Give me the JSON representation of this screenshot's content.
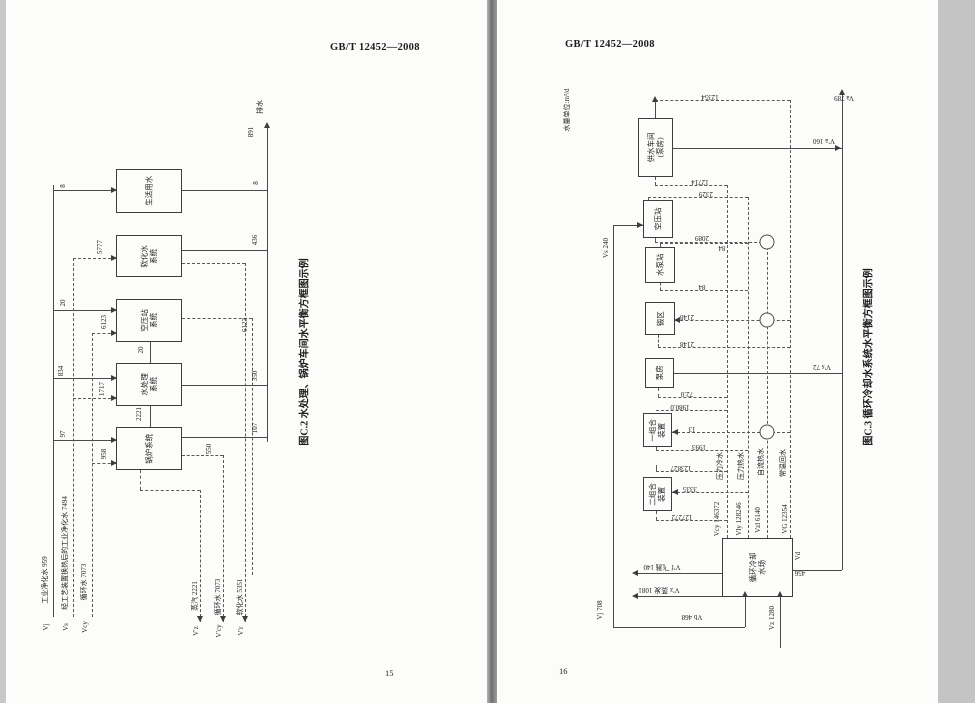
{
  "left_page": {
    "header": "GB/T 12452—2008",
    "page_number": "15",
    "caption": "图C.2  水处理、锅炉车间水平衡方框图示例",
    "boxes": [
      {
        "x": 116,
        "y": 169,
        "w": 66,
        "h": 44,
        "label": "生活用水"
      },
      {
        "x": 116,
        "y": 235,
        "w": 66,
        "h": 42,
        "label": "软化水\n系统"
      },
      {
        "x": 116,
        "y": 299,
        "w": 66,
        "h": 43,
        "label": "空压站\n系统"
      },
      {
        "x": 116,
        "y": 363,
        "w": 66,
        "h": 43,
        "label": "水处理\n系统"
      },
      {
        "x": 116,
        "y": 427,
        "w": 66,
        "h": 43,
        "label": "锅炉系统"
      }
    ],
    "labels": [
      {
        "x": 64,
        "y": 186,
        "t": "8",
        "r": -90
      },
      {
        "x": 64,
        "y": 303,
        "t": "20",
        "r": -90
      },
      {
        "x": 62,
        "y": 371,
        "t": "834",
        "r": -90
      },
      {
        "x": 64,
        "y": 434,
        "t": "97",
        "r": -90
      },
      {
        "x": 101,
        "y": 247,
        "t": "5777",
        "r": -90
      },
      {
        "x": 103,
        "y": 389,
        "t": "1717",
        "r": -90
      },
      {
        "x": 105,
        "y": 322,
        "t": "6123",
        "r": -90
      },
      {
        "x": 105,
        "y": 454,
        "t": "958",
        "r": -90
      },
      {
        "x": 142,
        "y": 350,
        "t": "20",
        "r": -90
      },
      {
        "x": 140,
        "y": 414,
        "t": "2221",
        "r": -90
      },
      {
        "x": 252,
        "y": 132,
        "t": "891",
        "r": -90
      },
      {
        "x": 261,
        "y": 107,
        "t": "排水",
        "r": -90
      },
      {
        "x": 257,
        "y": 183,
        "t": "8",
        "r": -90
      },
      {
        "x": 256,
        "y": 240,
        "t": "436",
        "r": -90
      },
      {
        "x": 256,
        "y": 376,
        "t": "350",
        "r": -90
      },
      {
        "x": 256,
        "y": 428,
        "t": "107",
        "r": -90
      },
      {
        "x": 246,
        "y": 325,
        "t": "6123",
        "r": -90
      },
      {
        "x": 210,
        "y": 449,
        "t": "550",
        "r": -90
      },
      {
        "x": 46,
        "y": 580,
        "t": "工业净化水 959",
        "r": -90
      },
      {
        "x": 66,
        "y": 553,
        "t": "经工艺装置换热后的工业净化水 7494",
        "r": -90
      },
      {
        "x": 85,
        "y": 582,
        "t": "循环水 7073",
        "r": -90
      },
      {
        "x": 196,
        "y": 596,
        "t": "蒸汽 2221",
        "r": -90
      },
      {
        "x": 219,
        "y": 597,
        "t": "循环水 7073",
        "r": -90
      },
      {
        "x": 241,
        "y": 597,
        "t": "软化水 5351",
        "r": -90
      },
      {
        "x": 47,
        "y": 627,
        "t": "Vj",
        "r": -90
      },
      {
        "x": 67,
        "y": 627,
        "t": "Vs",
        "r": -90
      },
      {
        "x": 86,
        "y": 627,
        "t": "Vcy",
        "r": -90
      },
      {
        "x": 197,
        "y": 631,
        "t": "V′z",
        "r": -90
      },
      {
        "x": 220,
        "y": 631,
        "t": "V′cy",
        "r": -90
      },
      {
        "x": 242,
        "y": 631,
        "t": "V′r",
        "r": -90
      }
    ],
    "solid": [
      [
        53,
        185,
        432,
        "v"
      ],
      [
        53,
        190,
        63,
        "h"
      ],
      [
        53,
        310,
        63,
        "h"
      ],
      [
        53,
        378,
        63,
        "h"
      ],
      [
        53,
        440,
        63,
        "h"
      ],
      [
        150,
        342,
        21,
        "v"
      ],
      [
        150,
        406,
        21,
        "v"
      ],
      [
        182,
        190,
        85,
        "h"
      ],
      [
        182,
        250,
        85,
        "h"
      ],
      [
        182,
        385,
        85,
        "h"
      ],
      [
        182,
        437,
        85,
        "h"
      ],
      [
        267,
        128,
        314,
        "v"
      ]
    ],
    "dashed": [
      [
        73,
        258,
        359,
        "v"
      ],
      [
        73,
        258,
        43,
        "h"
      ],
      [
        73,
        398,
        43,
        "h"
      ],
      [
        92,
        333,
        284,
        "v"
      ],
      [
        92,
        333,
        24,
        "h"
      ],
      [
        92,
        463,
        24,
        "h"
      ],
      [
        182,
        263,
        63,
        "h"
      ],
      [
        245,
        263,
        359,
        "v"
      ],
      [
        182,
        318,
        70,
        "h"
      ],
      [
        252,
        318,
        257,
        "v"
      ],
      [
        182,
        455,
        41,
        "h"
      ],
      [
        223,
        455,
        167,
        "v"
      ],
      [
        140,
        470,
        20,
        "v"
      ],
      [
        140,
        490,
        60,
        "h"
      ],
      [
        200,
        490,
        132,
        "v"
      ]
    ],
    "arrows": [
      [
        114,
        190,
        "r"
      ],
      [
        114,
        258,
        "r"
      ],
      [
        114,
        310,
        "r"
      ],
      [
        114,
        333,
        "r"
      ],
      [
        114,
        378,
        "r"
      ],
      [
        114,
        398,
        "r"
      ],
      [
        114,
        440,
        "r"
      ],
      [
        114,
        463,
        "r"
      ],
      [
        267,
        125,
        "u"
      ],
      [
        200,
        619,
        "d"
      ],
      [
        223,
        619,
        "d"
      ],
      [
        245,
        619,
        "d"
      ]
    ],
    "circles": []
  },
  "right_page": {
    "header": "GB/T 12452—2008",
    "page_number": "16",
    "caption": "图C.3  循环冷却水系统水平衡方框图示例",
    "unit_note": "水量单位:m³/d",
    "boxes": [
      {
        "x": 638,
        "y": 118,
        "w": 35,
        "h": 59,
        "label": "供水车间\n(泵房)"
      },
      {
        "x": 643,
        "y": 200,
        "w": 30,
        "h": 38,
        "label": "空压站"
      },
      {
        "x": 645,
        "y": 247,
        "w": 30,
        "h": 36,
        "label": "水泵站"
      },
      {
        "x": 645,
        "y": 302,
        "w": 30,
        "h": 33,
        "label": "锻区"
      },
      {
        "x": 645,
        "y": 358,
        "w": 29,
        "h": 30,
        "label": "泵房"
      },
      {
        "x": 643,
        "y": 413,
        "w": 29,
        "h": 34,
        "label": "一组合\n装置"
      },
      {
        "x": 643,
        "y": 477,
        "w": 29,
        "h": 34,
        "label": "二组合\n装置"
      },
      {
        "x": 722,
        "y": 538,
        "w": 71,
        "h": 59,
        "label": "循环冷却\n水场"
      }
    ],
    "labels": [
      {
        "x": 568,
        "y": 110,
        "t": "水量单位:m³/d",
        "r": -90
      },
      {
        "x": 607,
        "y": 248,
        "t": "Vs 240",
        "r": -90
      },
      {
        "x": 601,
        "y": 610,
        "t": "Vj 708",
        "r": -90
      },
      {
        "x": 710,
        "y": 96,
        "t": "12354",
        "r": 180
      },
      {
        "x": 700,
        "y": 181,
        "t": "12714",
        "r": 180
      },
      {
        "x": 706,
        "y": 193,
        "t": "2329",
        "r": 180
      },
      {
        "x": 702,
        "y": 237,
        "t": "2089",
        "r": 180
      },
      {
        "x": 722,
        "y": 247,
        "t": "84",
        "r": 180
      },
      {
        "x": 702,
        "y": 286,
        "t": "84",
        "r": 180
      },
      {
        "x": 687,
        "y": 316,
        "t": "2148",
        "r": 180
      },
      {
        "x": 687,
        "y": 343,
        "t": "2148",
        "r": 180
      },
      {
        "x": 687,
        "y": 393,
        "t": "72.0",
        "r": 180
      },
      {
        "x": 680,
        "y": 406,
        "t": "1980.0",
        "r": 180
      },
      {
        "x": 692,
        "y": 428,
        "t": "13",
        "r": 180
      },
      {
        "x": 699,
        "y": 446,
        "t": "1993",
        "r": 180
      },
      {
        "x": 681,
        "y": 467,
        "t": "123827",
        "r": 180
      },
      {
        "x": 690,
        "y": 488,
        "t": "3335",
        "r": 180
      },
      {
        "x": 682,
        "y": 516,
        "t": "127272",
        "r": 180
      },
      {
        "x": 721,
        "y": 466,
        "t": "压力冷水",
        "r": -90
      },
      {
        "x": 742,
        "y": 466,
        "t": "压力热水",
        "r": -90
      },
      {
        "x": 762,
        "y": 462,
        "t": "自流热水",
        "r": -90
      },
      {
        "x": 784,
        "y": 463,
        "t": "常温回水",
        "r": -90
      },
      {
        "x": 718,
        "y": 519,
        "t": "Vcy 146372",
        "r": -90
      },
      {
        "x": 740,
        "y": 519,
        "t": "Vly 128246",
        "r": -90
      },
      {
        "x": 759,
        "y": 520,
        "t": "Vzl 6140",
        "r": -90
      },
      {
        "x": 786,
        "y": 519,
        "t": "VG 12354",
        "r": -90
      },
      {
        "x": 662,
        "y": 566,
        "t": "V′f 飞溅 140",
        "r": 180
      },
      {
        "x": 659,
        "y": 589,
        "t": "V′z 蒸发 1081",
        "r": 180
      },
      {
        "x": 799,
        "y": 556,
        "t": "Vd",
        "r": -90
      },
      {
        "x": 800,
        "y": 572,
        "t": "456",
        "r": 180
      },
      {
        "x": 692,
        "y": 616,
        "t": "Vb 468",
        "r": 180
      },
      {
        "x": 773,
        "y": 618,
        "t": "Vz 1280",
        "r": -90
      },
      {
        "x": 824,
        "y": 140,
        "t": "V′a 160",
        "r": 180
      },
      {
        "x": 844,
        "y": 97,
        "t": "Va 789",
        "r": 180
      },
      {
        "x": 822,
        "y": 366,
        "t": "V′s 72",
        "r": 180
      }
    ],
    "solid": [
      [
        655,
        100,
        18,
        "v"
      ],
      [
        673,
        148,
        169,
        "h"
      ],
      [
        842,
        95,
        475,
        "v"
      ],
      [
        672,
        373,
        170,
        "h"
      ],
      [
        793,
        570,
        49,
        "h"
      ],
      [
        613,
        225,
        402,
        "v"
      ],
      [
        613,
        225,
        30,
        "h"
      ],
      [
        613,
        627,
        132,
        "h"
      ],
      [
        745,
        597,
        30,
        "v"
      ],
      [
        780,
        597,
        51,
        "v"
      ],
      [
        638,
        573,
        84,
        "h"
      ],
      [
        638,
        596,
        84,
        "h"
      ]
    ],
    "dashed": [
      [
        655,
        100,
        135,
        "h"
      ],
      [
        790,
        100,
        438,
        "v"
      ],
      [
        727,
        185,
        353,
        "v"
      ],
      [
        748,
        197,
        341,
        "v"
      ],
      [
        767,
        242,
        296,
        "v"
      ],
      [
        655,
        177,
        8,
        "v"
      ],
      [
        655,
        185,
        72,
        "h"
      ],
      [
        648,
        197,
        3,
        "v"
      ],
      [
        648,
        197,
        100,
        "h"
      ],
      [
        655,
        238,
        4,
        "v"
      ],
      [
        655,
        242,
        112,
        "h"
      ],
      [
        660,
        243,
        4,
        "v"
      ],
      [
        660,
        243,
        88,
        "h"
      ],
      [
        660,
        283,
        7,
        "v"
      ],
      [
        660,
        290,
        88,
        "h"
      ],
      [
        675,
        320,
        115,
        "h"
      ],
      [
        658,
        335,
        12,
        "v"
      ],
      [
        658,
        347,
        132,
        "h"
      ],
      [
        658,
        388,
        9,
        "v"
      ],
      [
        658,
        397,
        69,
        "h"
      ],
      [
        656,
        410,
        71,
        "h"
      ],
      [
        672,
        432,
        118,
        "h"
      ],
      [
        656,
        447,
        3,
        "v"
      ],
      [
        656,
        450,
        92,
        "h"
      ],
      [
        656,
        465,
        6,
        "v"
      ],
      [
        656,
        471,
        71,
        "h"
      ],
      [
        672,
        492,
        76,
        "h"
      ],
      [
        656,
        511,
        9,
        "v"
      ],
      [
        656,
        520,
        71,
        "h"
      ]
    ],
    "arrows": [
      [
        842,
        92,
        "u"
      ],
      [
        655,
        99,
        "u"
      ],
      [
        635,
        573,
        "l"
      ],
      [
        635,
        596,
        "l"
      ],
      [
        677,
        320,
        "l"
      ],
      [
        675,
        432,
        "l"
      ],
      [
        675,
        492,
        "l"
      ],
      [
        745,
        594,
        "u"
      ],
      [
        780,
        594,
        "u"
      ],
      [
        838,
        148,
        "r"
      ],
      [
        640,
        225,
        "r"
      ]
    ],
    "circles": [
      [
        767,
        242
      ],
      [
        767,
        320
      ],
      [
        767,
        432
      ]
    ]
  }
}
